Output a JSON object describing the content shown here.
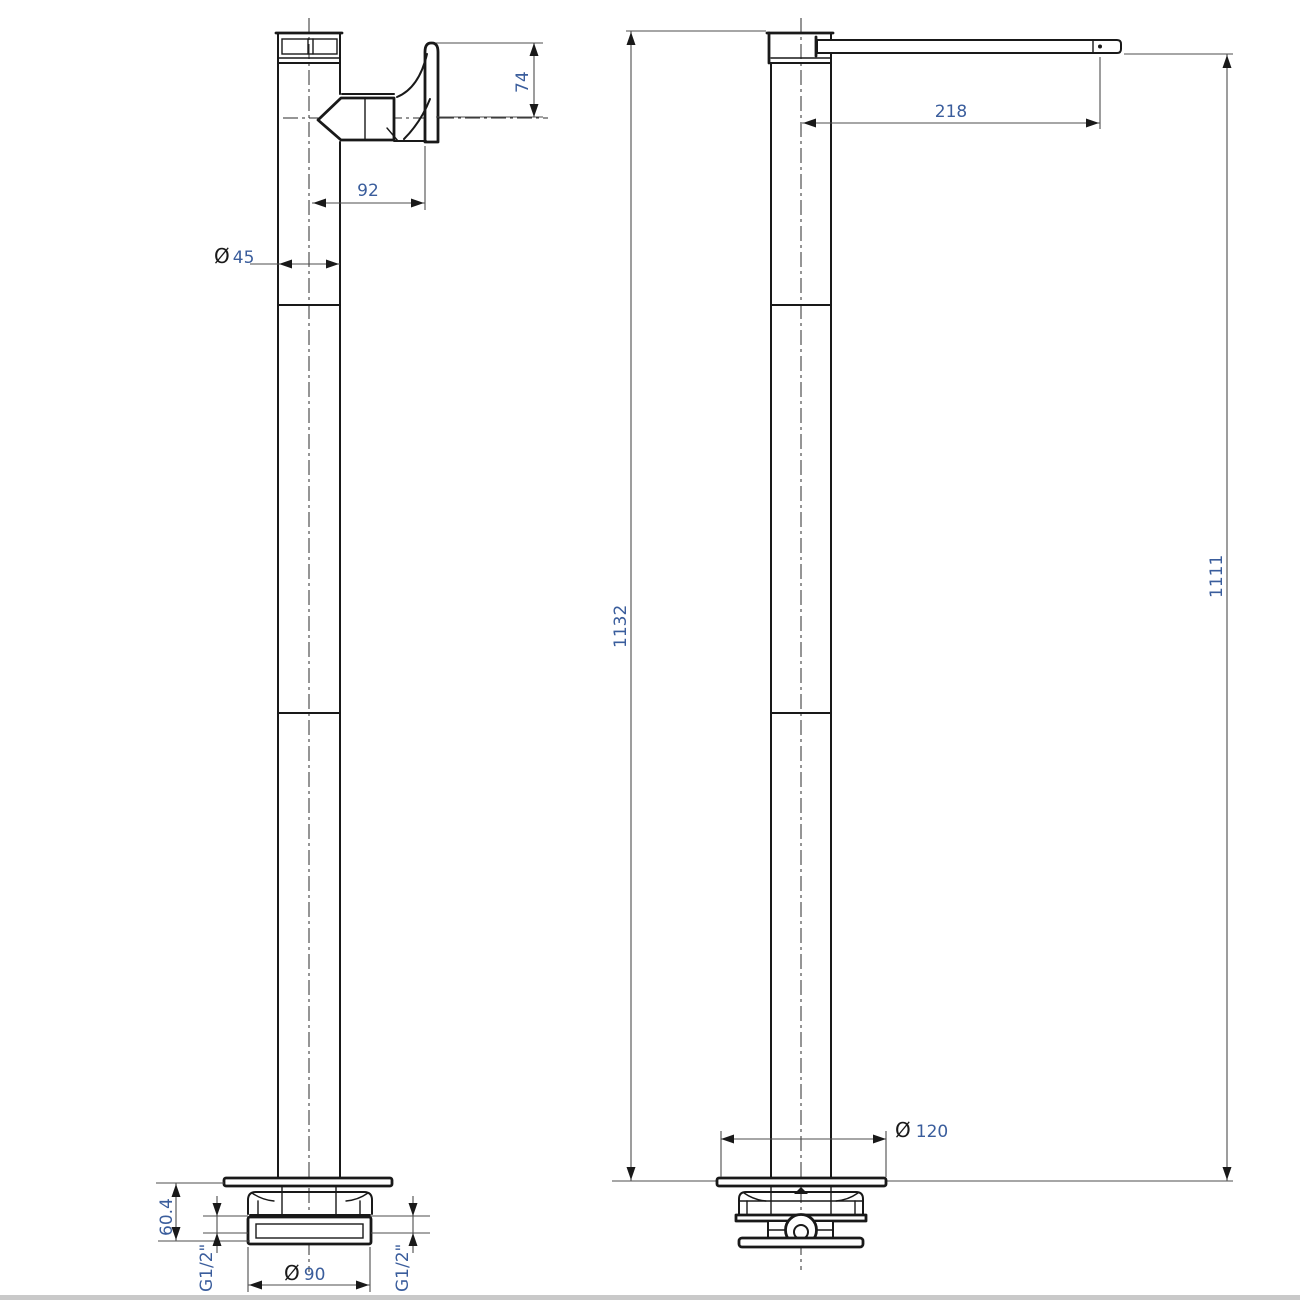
{
  "page": {
    "background": "#ffffff",
    "footer_bar_color": "#c9c9c9"
  },
  "drawing": {
    "subject": "Freestanding single-lever basin mixer tap — dimensional drawing, two elevations",
    "views": [
      {
        "id": "side",
        "label": "side elevation with lever handle"
      },
      {
        "id": "front",
        "label": "front elevation with spout"
      }
    ]
  },
  "dims": {
    "d74": {
      "value": "74"
    },
    "d92": {
      "value": "92"
    },
    "d45": {
      "prefix": "Ø",
      "value": "45"
    },
    "d604": {
      "value": "60.4"
    },
    "d90": {
      "prefix": "Ø",
      "value": "90"
    },
    "g12_left": {
      "value": "G1/2\""
    },
    "g12_right": {
      "value": "G1/2\""
    },
    "d1132": {
      "value": "1132"
    },
    "d218": {
      "value": "218"
    },
    "d120": {
      "prefix": "Ø",
      "value": "120"
    },
    "d1111": {
      "value": "1111"
    }
  },
  "colors": {
    "object_line": "#191919",
    "dimension_line": "#4d4d4d",
    "dimension_text": "#3a5d9c",
    "centerline": "#2b2b2b"
  }
}
